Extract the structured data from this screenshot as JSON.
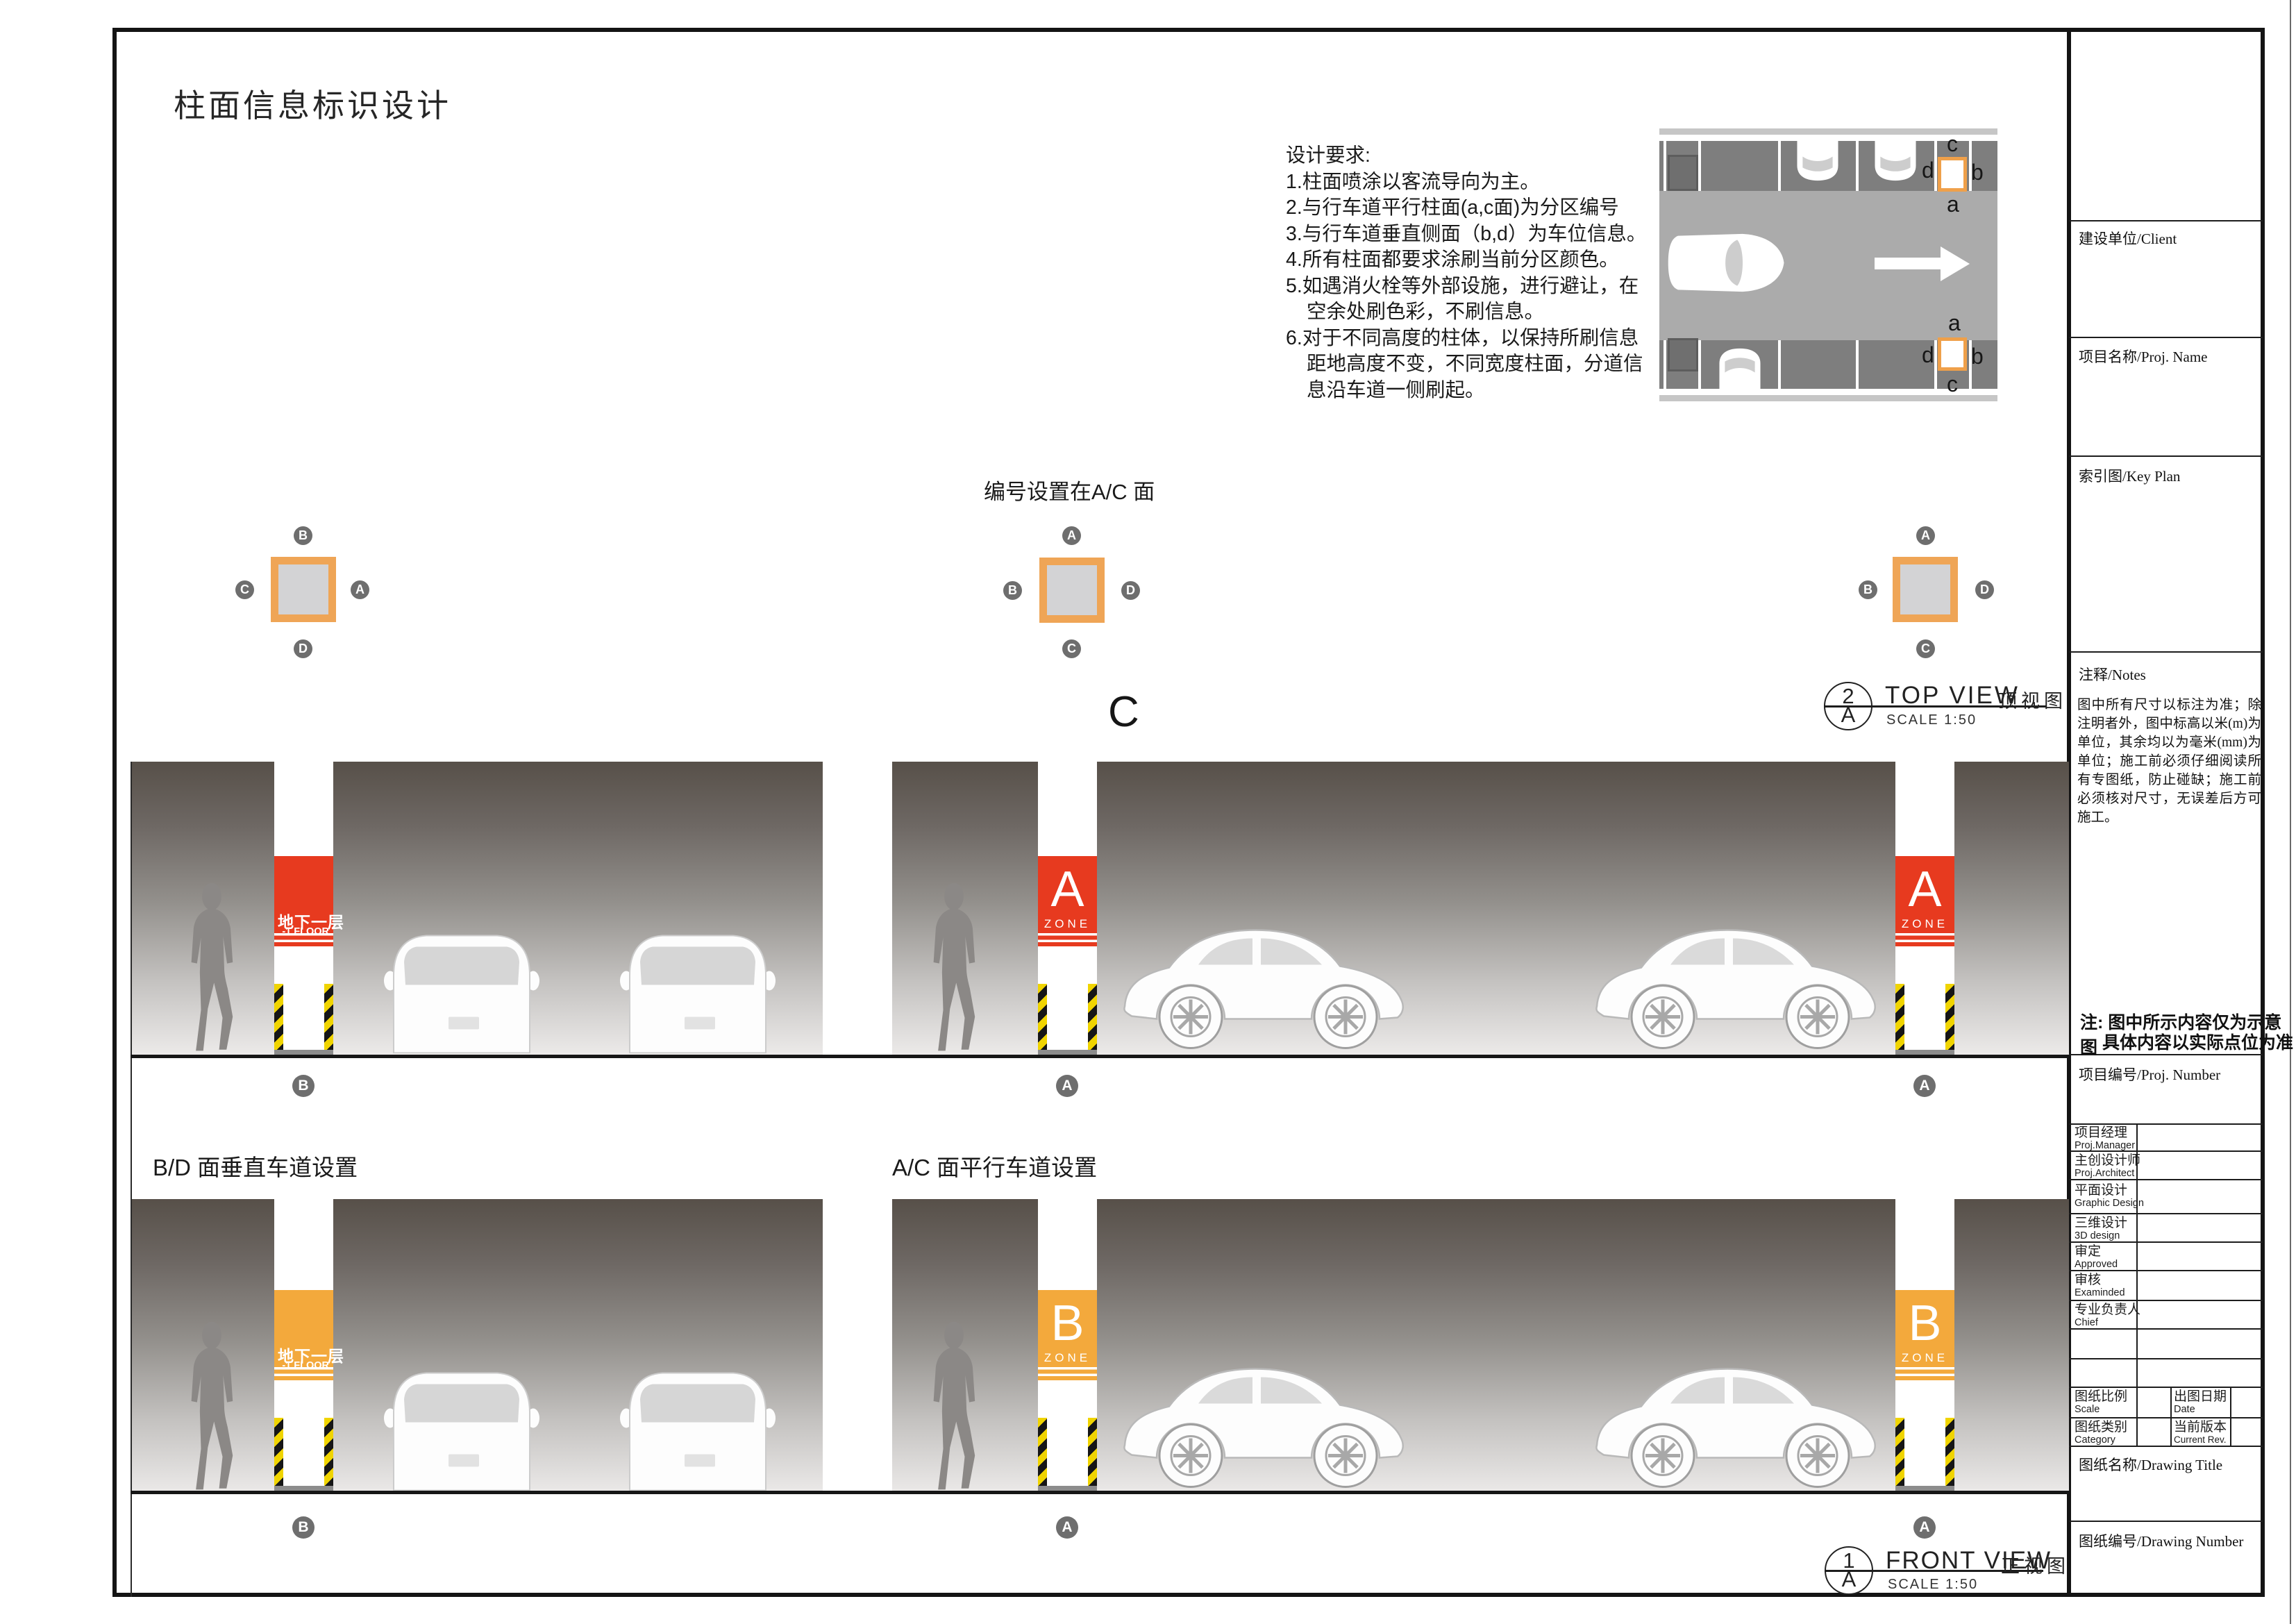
{
  "page_title": "柱面信息标识设计",
  "design_requirements": {
    "title": "设计要求:",
    "lines": [
      "1.柱面喷涂以客流导向为主。",
      "2.与行车道平行柱面(a,c面)为分区编号",
      "3.与行车道垂直侧面（b,d）为车位信息。",
      "4.所有柱面都要求涂刷当前分区颜色。",
      "5.如遇消火栓等外部设施，进行避让，在",
      "空余处刷色彩，不刷信息。",
      "6.对于不同高度的柱体，以保持所刷信息",
      "距地高度不变，不同宽度柱面，分道信",
      "息沿车道一侧刷起。"
    ]
  },
  "numbering_heading": "编号设置在A/C 面",
  "big_letter": "C",
  "top_view_diagram": {
    "top_column": {
      "top": "c",
      "left": "d",
      "right": "b",
      "bottom": "a"
    },
    "bottom_column": {
      "top": "a",
      "left": "d",
      "right": "b",
      "bottom": "c"
    }
  },
  "cross_sections": {
    "left": {
      "top": "B",
      "left": "C",
      "right": "A",
      "bottom": "D"
    },
    "middle": {
      "top": "A",
      "left": "B",
      "right": "D",
      "bottom": "C"
    },
    "right": {
      "top": "A",
      "left": "B",
      "right": "D",
      "bottom": "C"
    }
  },
  "viewports": {
    "top_view": {
      "num": "2",
      "sheet": "A",
      "title": "TOP VIEW",
      "title_cn": "顶视图",
      "scale": "SCALE  1:50"
    },
    "front_view": {
      "num": "1",
      "sheet": "A",
      "title": "FRONT VIEW",
      "title_cn": "正视图",
      "scale": "SCALE  1:50"
    }
  },
  "elevations": {
    "bd_label": "B/D 面垂直车道设置",
    "ac_label": "A/C 面平行车道设置",
    "floor_sign": {
      "cn": "地下一层",
      "en": "-1 FLOOR"
    },
    "zone_a": {
      "letter": "A",
      "word": "ZONE"
    },
    "zone_b": {
      "letter": "B",
      "word": "ZONE"
    },
    "circle_a": "A",
    "circle_b": "B"
  },
  "colors": {
    "zone_a_red": "#E73A1F",
    "zone_b_orange": "#F3A93C",
    "column_frame_orange": "#EFA556",
    "circle_gray": "#6E6E6E"
  },
  "sidebar": {
    "client": "建设单位/Client",
    "proj_name": "项目名称/Proj. Name",
    "key_plan": "索引图/Key Plan",
    "notes_label": "注释/Notes",
    "notes_text": "图中所有尺寸以标注为准；除注明者外，图中标高以米(m)为单位，其余均以为毫米(mm)为单位；施工前必须仔细阅读所有专图纸，防止碰缺；施工前必须核对尺寸，无误差后方可施工。",
    "note_line1": "注: 图中所示内容仅为示意图",
    "note_line2": "具体内容以实际点位为准",
    "proj_number": "项目编号/Proj. Number",
    "table": [
      {
        "cn": "项目经理",
        "en": "Proj.Manager"
      },
      {
        "cn": "主创设计师",
        "en": "Proj.Architect"
      },
      {
        "cn": "平面设计",
        "en": "Graphic Design"
      },
      {
        "cn": "三维设计",
        "en": "3D design"
      },
      {
        "cn": "审定",
        "en": "Approved"
      },
      {
        "cn": "审核",
        "en": "Examinded"
      },
      {
        "cn": "专业负责人",
        "en": "Chief"
      }
    ],
    "scale_label": {
      "cn": "图纸比例",
      "en": "Scale"
    },
    "date_label": {
      "cn": "出图日期",
      "en": "Date"
    },
    "category_label": {
      "cn": "图纸类别",
      "en": "Category"
    },
    "rev_label": {
      "cn": "当前版本",
      "en": "Current Rev."
    },
    "drawing_title": "图纸名称/Drawing Title",
    "drawing_number": "图纸编号/Drawing Number"
  }
}
